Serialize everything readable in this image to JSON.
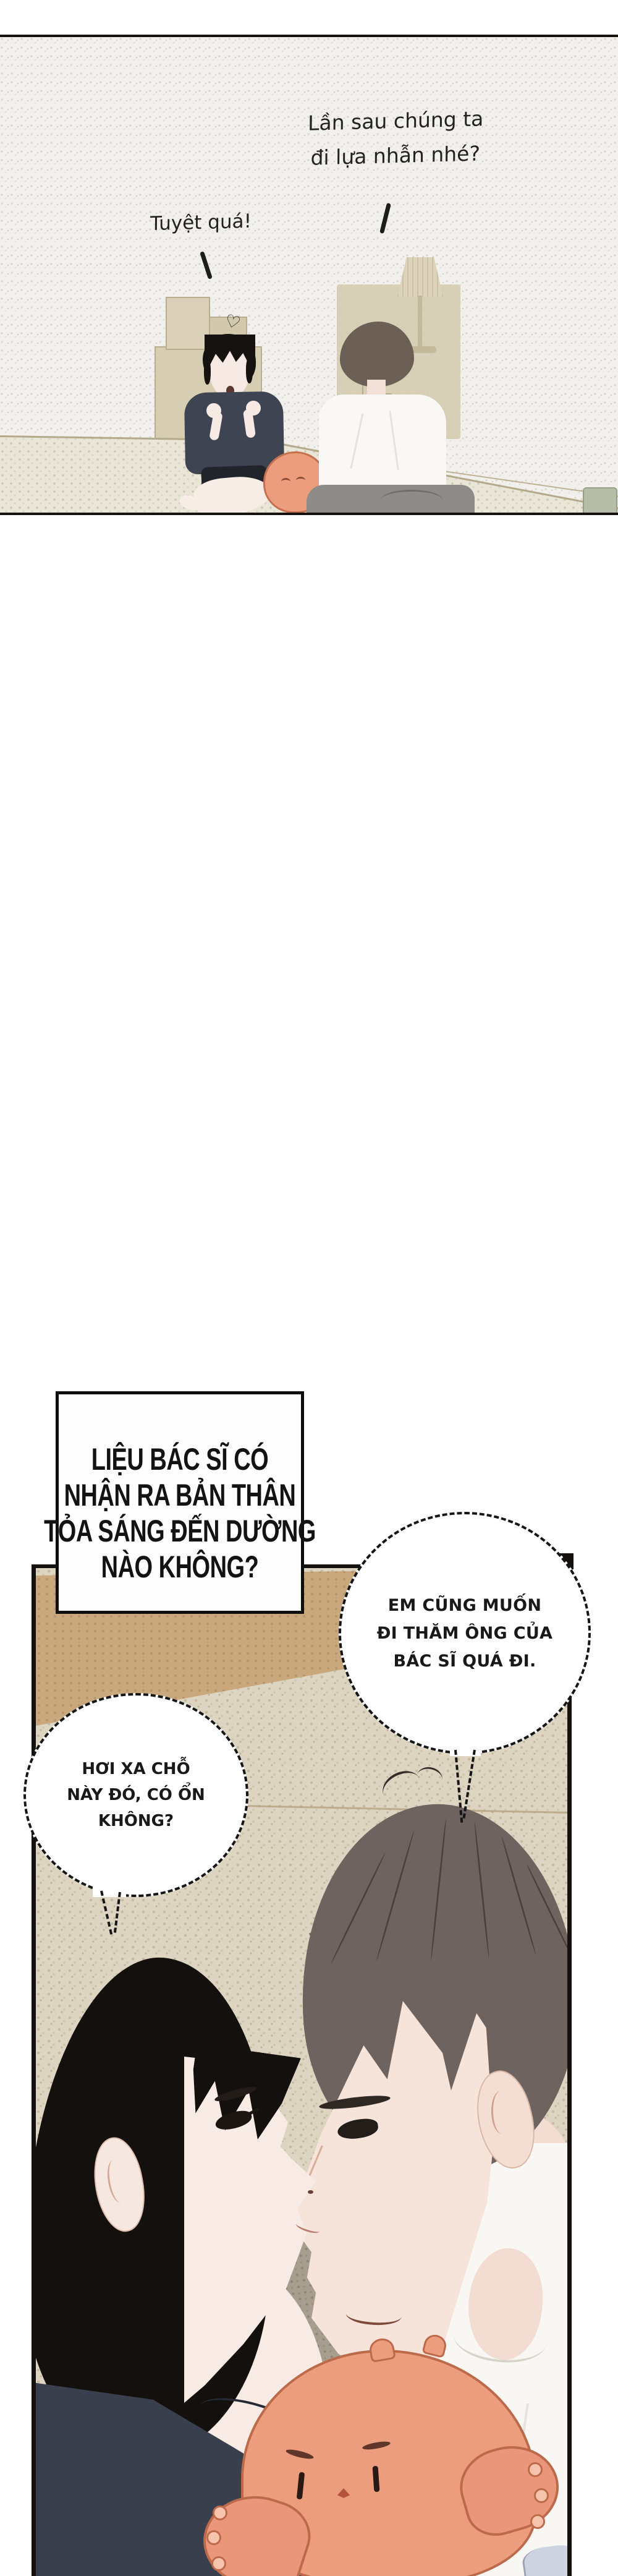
{
  "page": {
    "kind": "webtoon-comic-page",
    "background": "#ffffff"
  },
  "top_panel": {
    "speech_right_line1": "Lần sau chúng ta",
    "speech_right_line2": "đi lựa nhẫn nhé?",
    "speech_left": "Tuyệt quá!",
    "heart": "♡"
  },
  "bottom": {
    "narration": {
      "lines": [
        "LIỆU BÁC SĨ CÓ",
        "NHẬN RA BẢN THÂN",
        "TỎA SÁNG ĐẾN DƯỜNG",
        "NÀO KHÔNG?"
      ]
    },
    "bubble_right": {
      "lines": [
        "EM CŨNG MUỐN",
        "ĐI THĂM ÔNG CỦA",
        "BÁC SĨ QUÁ ĐI."
      ]
    },
    "bubble_left": {
      "lines": [
        "HƠI XA CHỖ",
        "NÀY ĐÓ, CÓ ỔN",
        "KHÔNG?"
      ]
    }
  },
  "colors": {
    "panel_border": "#15110d",
    "wallpaper_base": "#f1f0ec",
    "wallpaper_dot": "#dbd8ce",
    "floor_base": "#e9e6d8",
    "bottom_wall_base": "#ddd5c2",
    "bottom_wall_dot": "#c6bba2",
    "tan_band": "#c9a87e",
    "plush_orange": "#ec9d7d",
    "plush_outline": "#bd6a4b",
    "navy_shirt": "#3a3f4d",
    "white_shirt": "#f8f7f4",
    "grey_pants": "#8d8c88",
    "skin": "#f6e6de",
    "black_hair": "#14100d",
    "brown_hair": "#6f6360",
    "text_ink": "#141414"
  }
}
